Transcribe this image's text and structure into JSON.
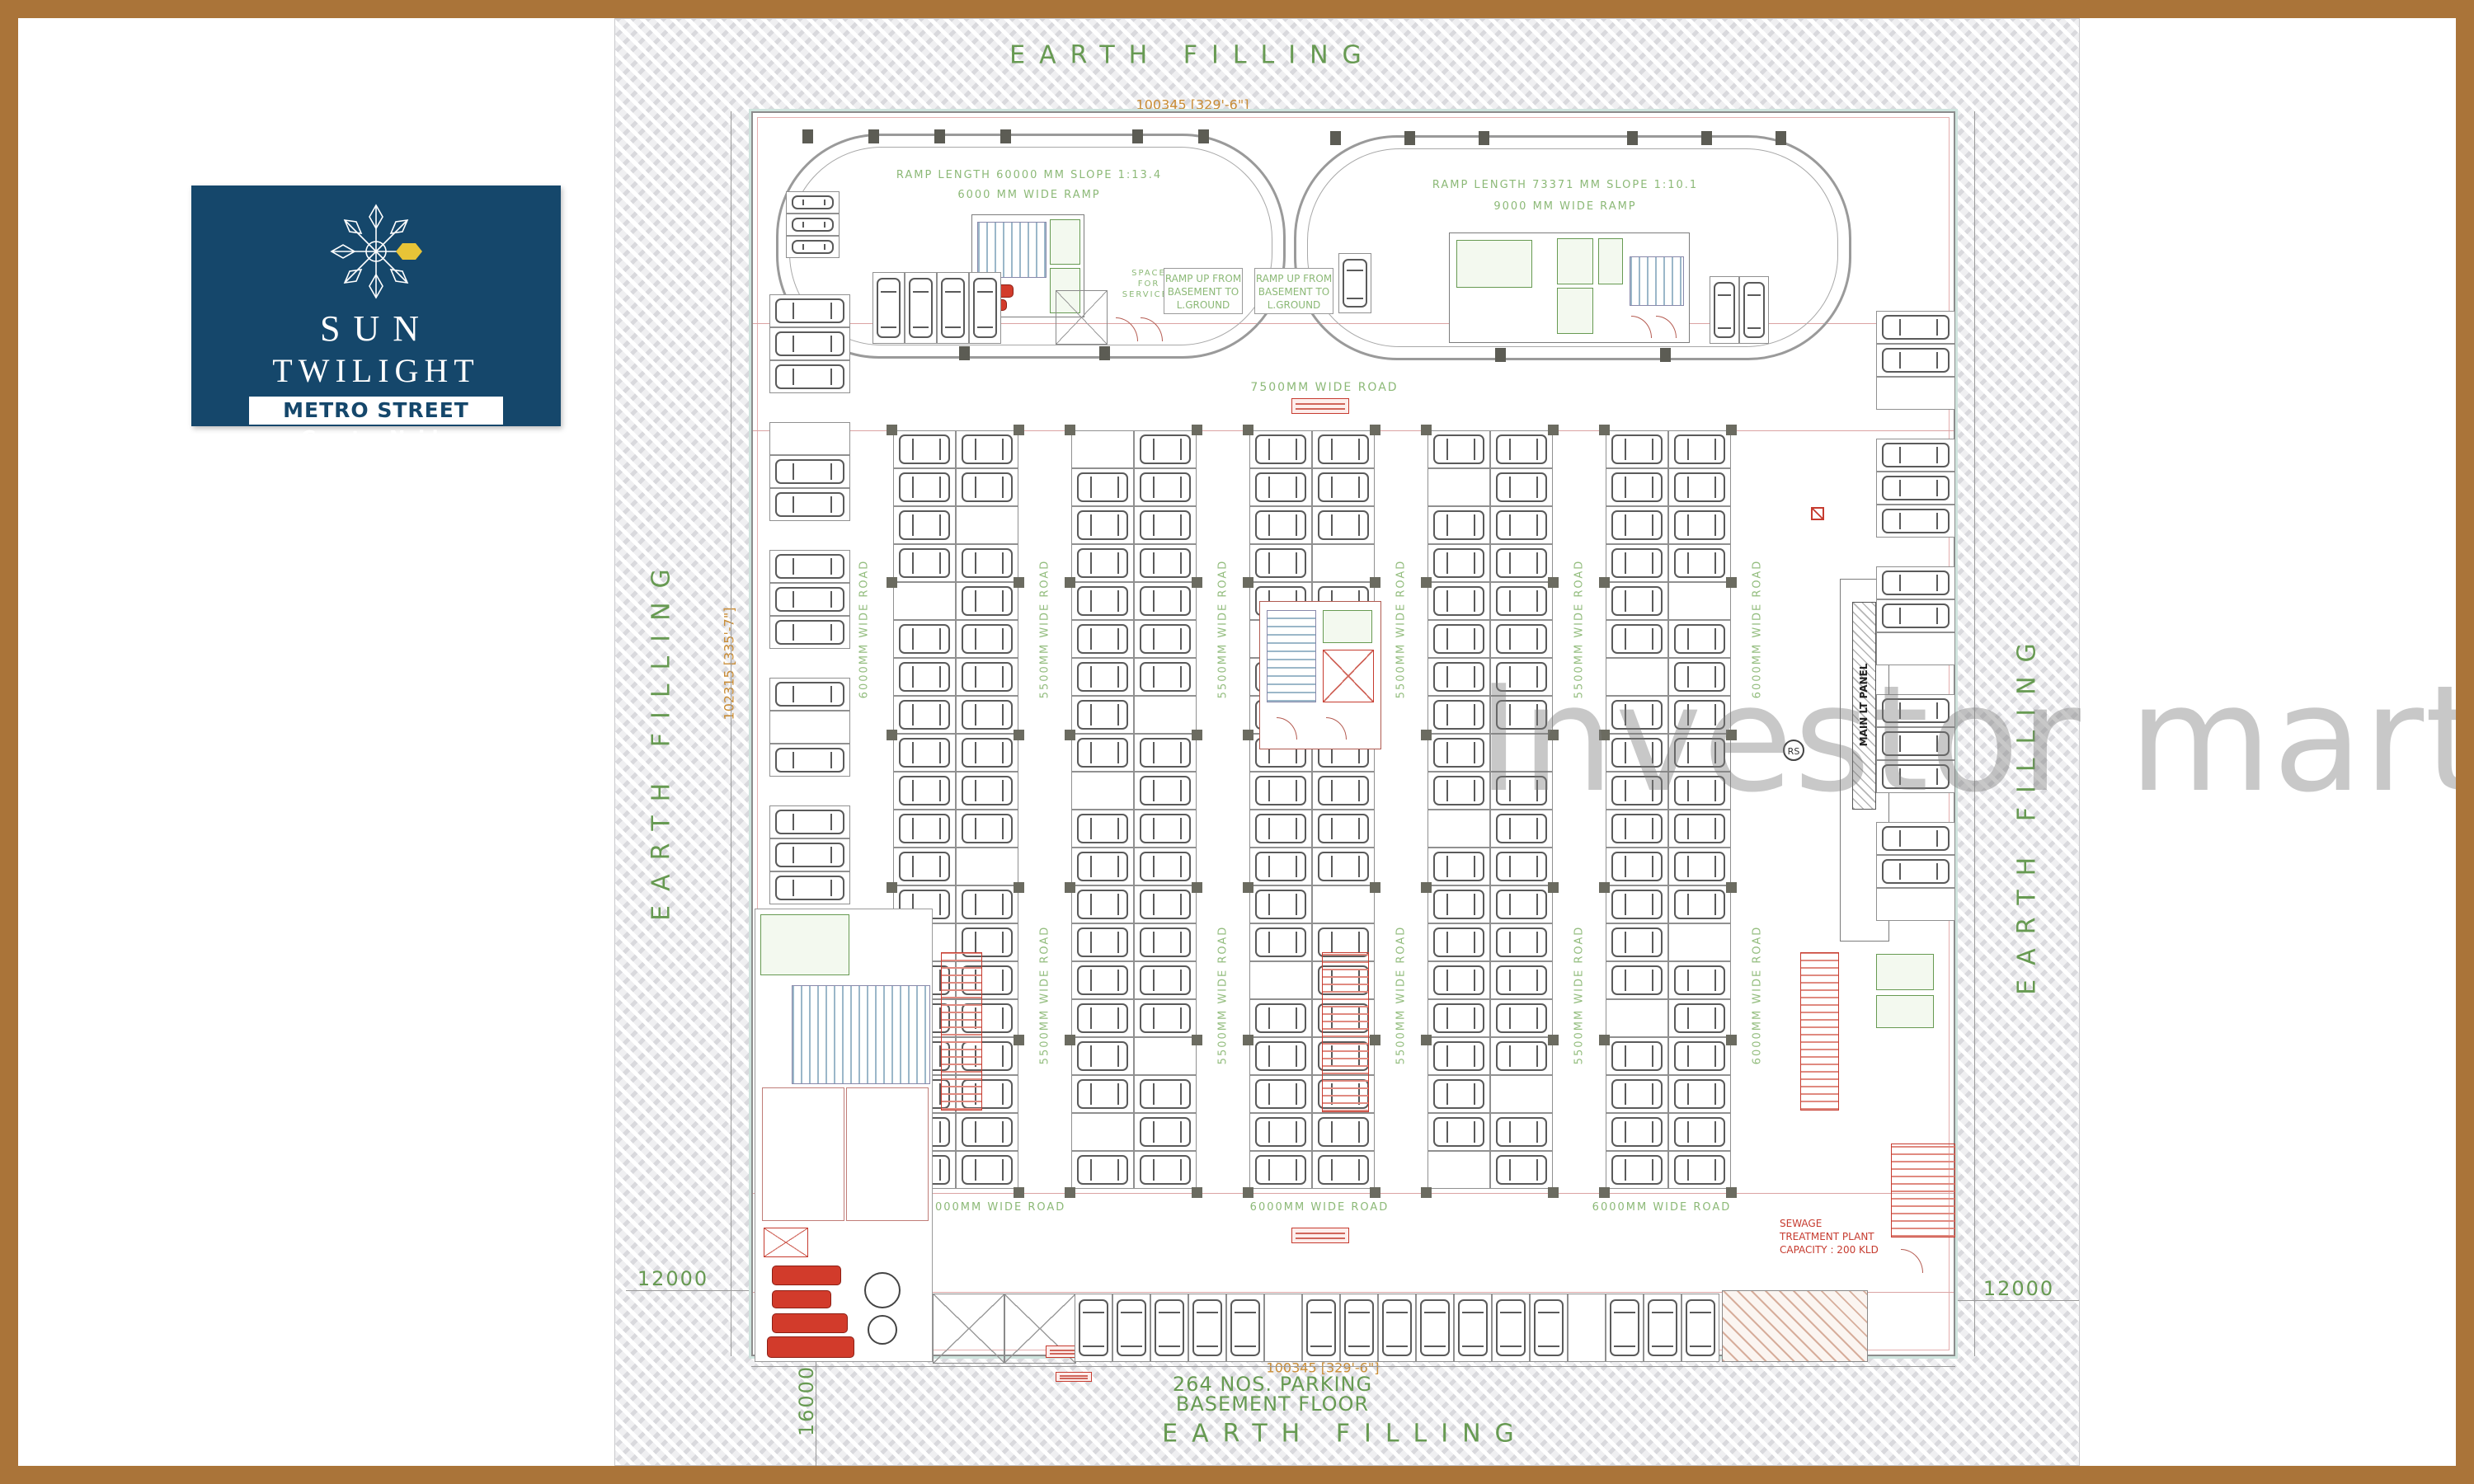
{
  "logo": {
    "line1": "SUN",
    "line2": "TWILIGHT",
    "banner": "METRO STREET",
    "city": "Greater Noida"
  },
  "earth": {
    "top": "EARTH FILLING",
    "bottom": "EARTH FILLING",
    "left": "EARTH FILLING",
    "right": "EARTH FILLING"
  },
  "dims": {
    "top": "100345 [329'-6\"]",
    "bottom": "100345 [329'-6\"]",
    "left": "102315 [335'-7\"]",
    "right": "102315 [335'-7\"]",
    "offset_left": "12000",
    "offset_right": "12000",
    "offset_bottom": "16000"
  },
  "ramps": {
    "left1": "RAMP LENGTH 60000 MM SLOPE 1:13.4",
    "left2": "6000 MM WIDE RAMP",
    "right1": "RAMP LENGTH 73371 MM SLOPE 1:10.1",
    "right2": "9000 MM WIDE RAMP",
    "up1": "RAMP UP FROM BASEMENT TO L.GROUND",
    "up2": "RAMP UP FROM BASEMENT TO L.GROUND",
    "space": "SPACE FOR SERVICES"
  },
  "roads": {
    "top": "7500MM WIDE ROAD",
    "vertical": [
      "6000MM WIDE ROAD",
      "5500MM WIDE ROAD",
      "5500MM WIDE ROAD",
      "5500MM WIDE ROAD",
      "5500MM WIDE ROAD",
      "6000MM WIDE ROAD"
    ],
    "bottom": [
      "6000MM WIDE ROAD",
      "6000MM WIDE ROAD",
      "6000MM WIDE ROAD"
    ]
  },
  "labels": {
    "panel": "MAIN LT PANEL",
    "rs": "RS",
    "stp1": "SEWAGE",
    "stp2": "TREATMENT PLANT",
    "stp3": "CAPACITY : 200 KLD"
  },
  "parking": {
    "note": "264 NOS. PARKING",
    "floor": "BASEMENT FLOOR",
    "column_groups": 5,
    "subcolumns_per_group": 2,
    "stalls_per_subcolumn": 20,
    "left_edge_groups": 5,
    "right_edge_groups": 5,
    "stalls_per_edge_group": 3,
    "bottom_row_stalls": 17,
    "loop_block_stalls": 4
  },
  "watermark": {
    "text": "Investor mart"
  },
  "colors": {
    "navy": "#15476b",
    "gold": "#e8c437",
    "green": "#679a52",
    "orange": "#c98c35",
    "red": "#c63b2f",
    "brown": "#aa7439",
    "pink": "#dba3a3"
  }
}
